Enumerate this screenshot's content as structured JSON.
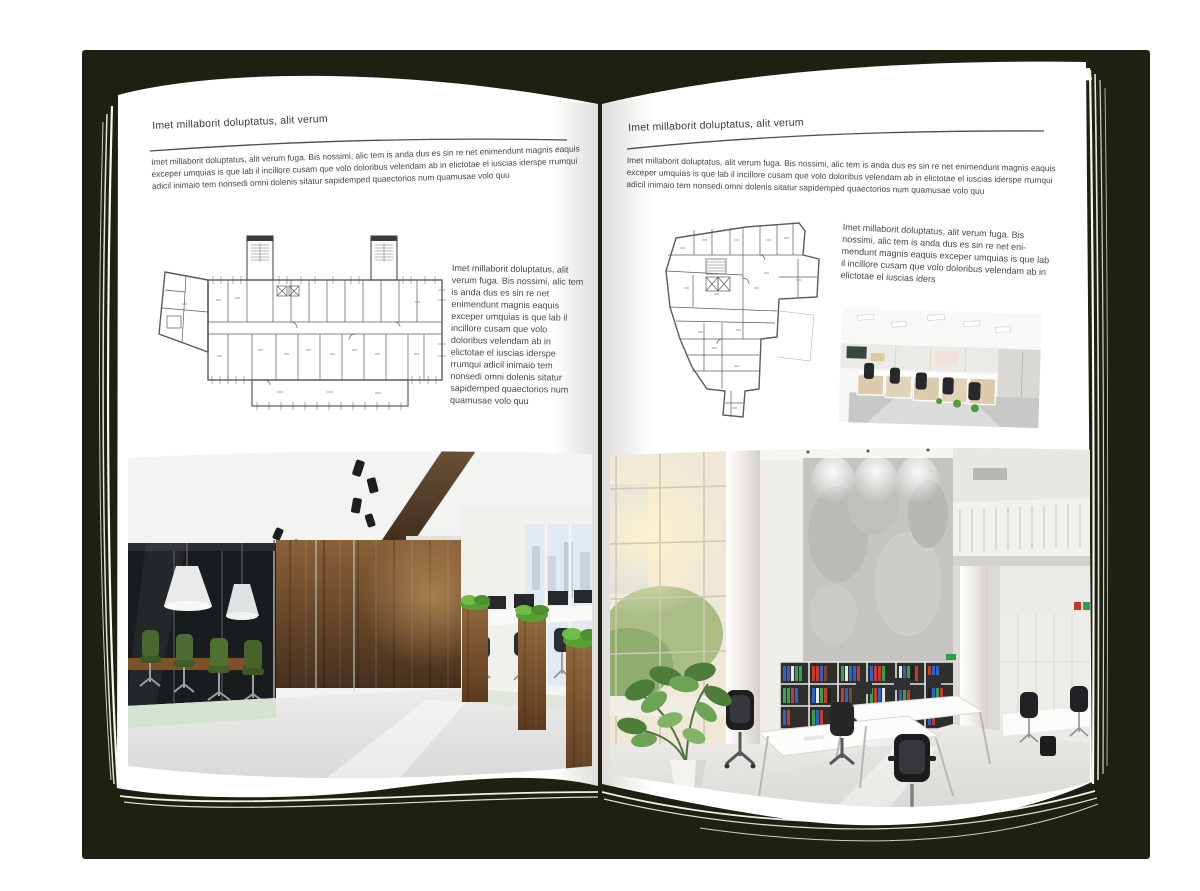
{
  "book": {
    "left_page": {
      "header": "Imet millaborit doluptatus, alit verum",
      "intro": "Imet millaborit doluptatus, alit verum fuga. Bis nossimi, alic tem is anda dus es sin re net enimendunt magnis eaquis exceper umquias is que lab il incillore cusam que volo doloribus velendam ab in elictotae el iuscias iderspe rrumqui adicil inimaio tem nonsedi omni dolenis sitatur sapidemped quaectorios num quamusae volo quu",
      "caption": "Imet millaborit doluptatus, alit verum fuga. Bis nossimi, alic tem is anda dus es sin re net enimendunt magnis eaquis exceper umquias is que lab il incillore cusam que volo doloribus velendam ab in elictotae el iuscias iderspe rrumqui adicil inimaio tem nonsedi omni dolenis sitatur sapidemped quaectorios num quamusae volo quu"
    },
    "right_page": {
      "header": "Imet millaborit doluptatus, alit verum",
      "intro": "Imet millaborit doluptatus, alit verum fuga. Bis nossimi, alic tem is anda dus es sin re net enimendunt magnis eaquis exceper umquias is que lab il incillore cusam que volo doloribus velendam ab in elictotae el iuscias iderspe rrumqui adicil inimaio tem nonsedi omni dolenis sitatur sapidemped quaectorios num quamusae volo quu",
      "caption": "Imet millaborit doluptatus, alit verum fuga. Bis nossimi, alic tem is anda dus es sin re net eni-mendunt magnis eaquis exceper umquias is que lab il incillore cusam que volo doloribus velendam ab in elictotae el iuscias iders"
    }
  },
  "figures": {
    "left_floor_plan": "building-floor-plan-drawing",
    "right_floor_plan": "building-floor-plan-drawing",
    "left_photo": "dark-wood-office-interior-photo",
    "right_photo_small": "open-plan-cubicle-office-photo",
    "right_photo_large": "bright-loft-office-interior-photo"
  },
  "colors": {
    "backdrop": "#1e2112",
    "page": "#ffffff",
    "text": "#474747",
    "rule": "#4d4d4d",
    "plan_line": "#5b5b5d",
    "wood": "#6b4a2c",
    "grass": "#5fae3a",
    "binder_blue": "#2e62c8",
    "binder_red": "#c93a2c",
    "binder_green": "#37a24a"
  }
}
